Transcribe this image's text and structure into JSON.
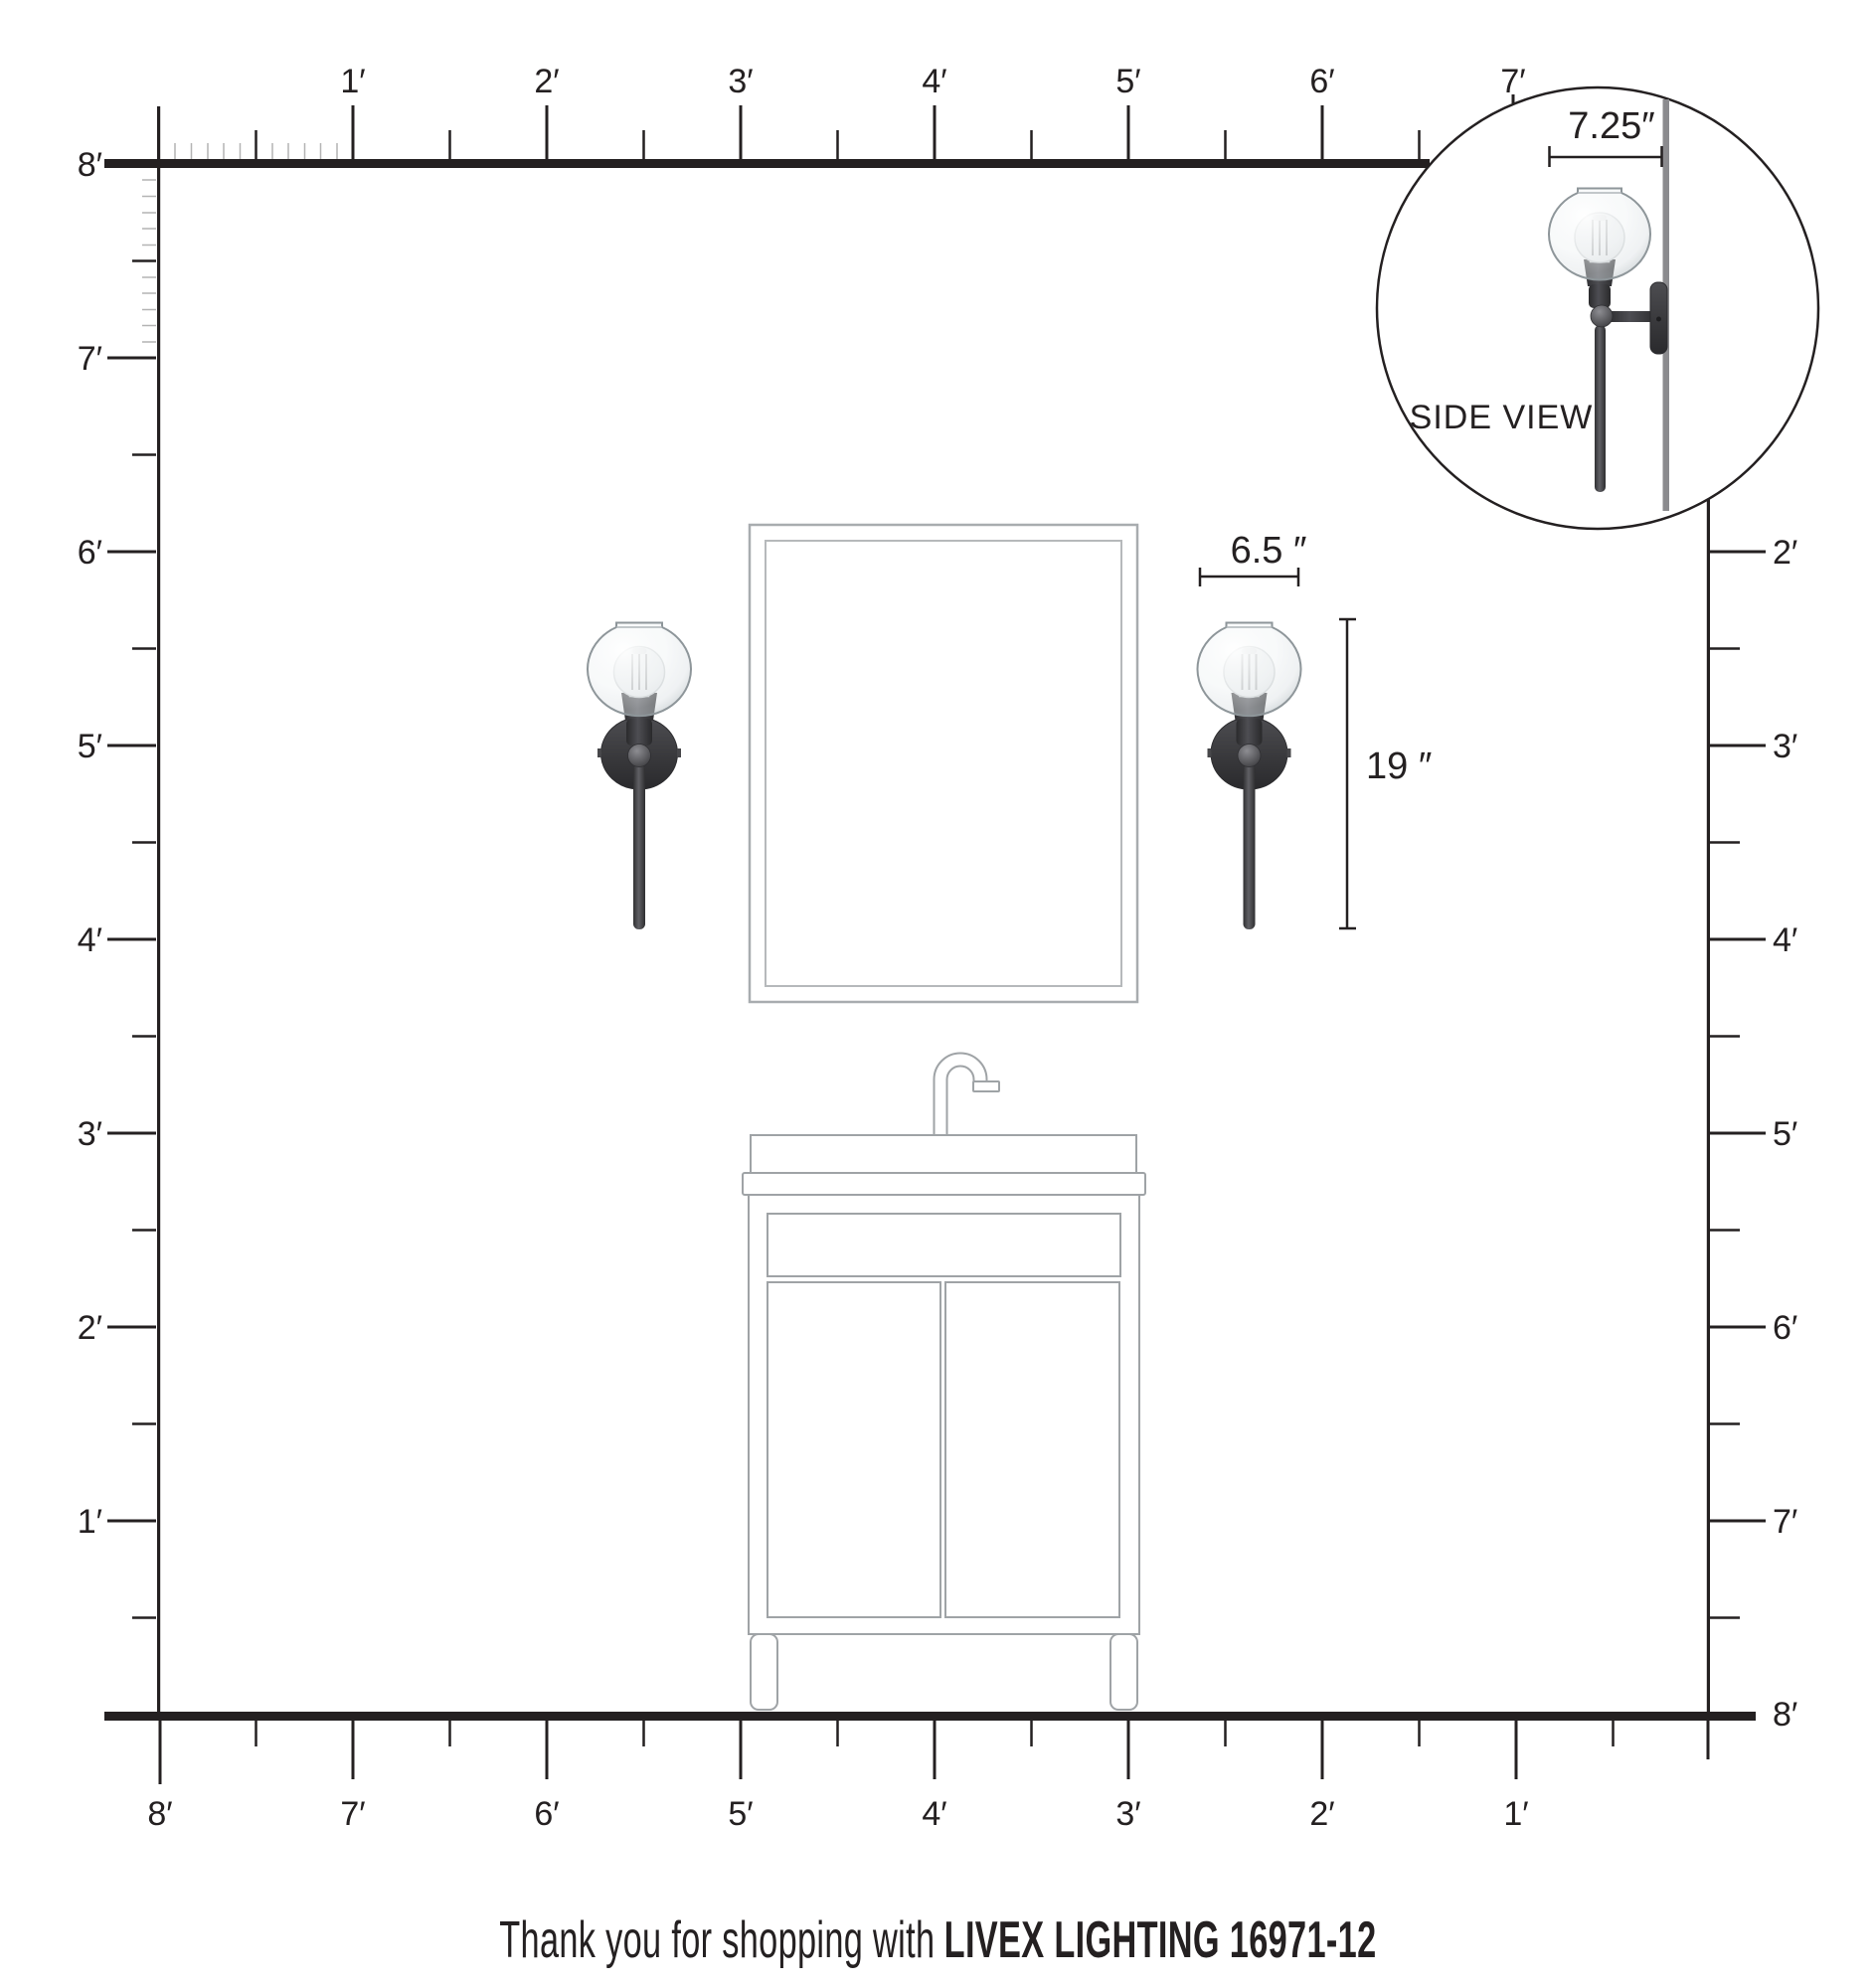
{
  "footer": {
    "prefix": "Thank you for shopping with",
    "brand": "LIVEX LIGHTING 16971-12"
  },
  "inset": {
    "label": "SIDE VIEW",
    "dim_label": "7.25″"
  },
  "fixture_dims": {
    "width_label": "6.5 ″",
    "height_label": "19 ″"
  },
  "rulers": {
    "top": [
      "1′",
      "2′",
      "3′",
      "4′",
      "5′",
      "6′",
      "7′"
    ],
    "left": [
      "8′",
      "7′",
      "6′",
      "5′",
      "4′",
      "3′",
      "2′",
      "1′"
    ],
    "right": [
      "2′",
      "3′",
      "4′",
      "5′",
      "6′",
      "7′",
      "8′"
    ],
    "bottom": [
      "8′",
      "7′",
      "6′",
      "5′",
      "4′",
      "3′",
      "2′",
      "1′"
    ]
  },
  "colors": {
    "ink": "#242021",
    "tick_minor": "#b4b4b4",
    "wall_line": "#8b8b8e",
    "hardware_dark": "#3a3a3d",
    "fixture_outline": "#9fa3a6",
    "mirror_outline": "#a8acaf"
  }
}
